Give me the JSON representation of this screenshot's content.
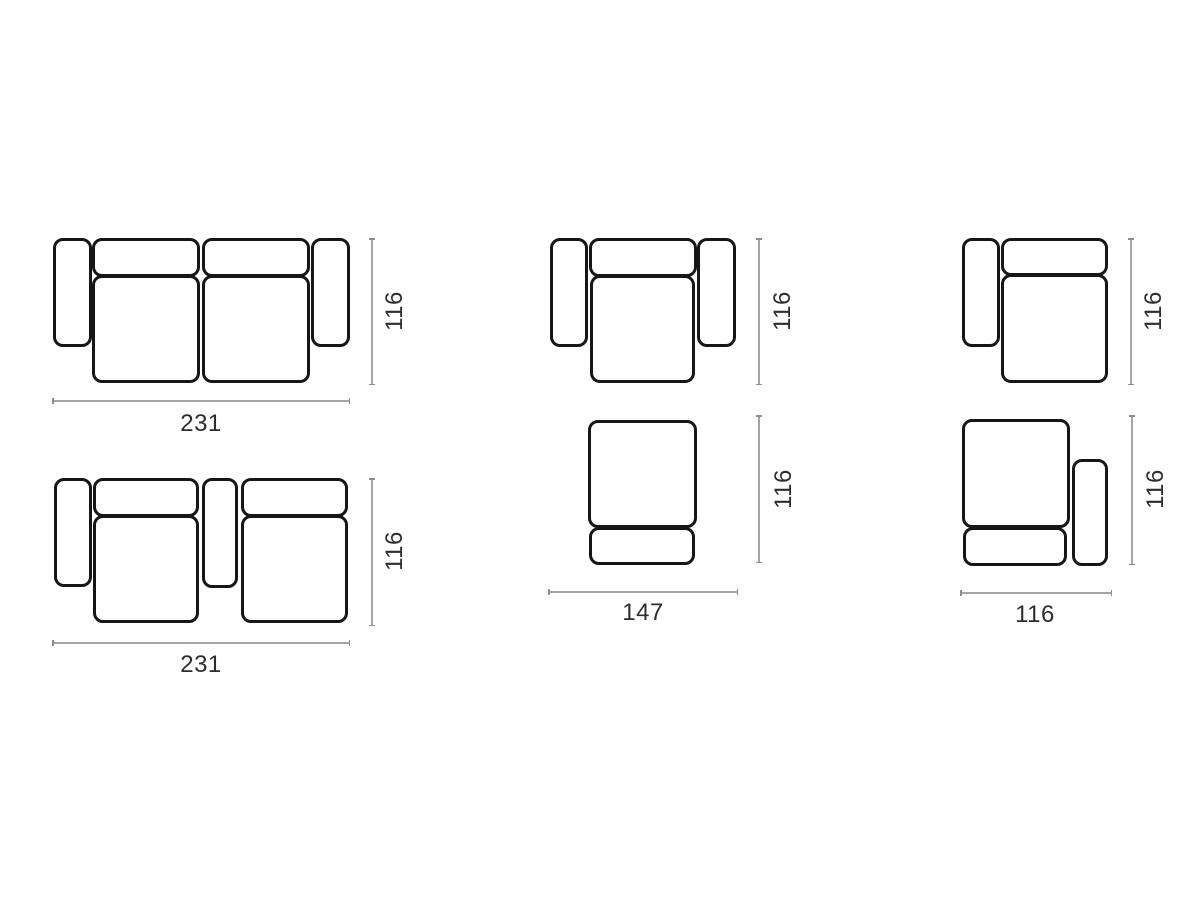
{
  "page": {
    "background_color": "#ffffff",
    "outline_color": "#161616",
    "dimension_line_color": "#a5a5a5",
    "label_color": "#2d2d2d"
  },
  "diagrams": {
    "sofa_two_arms": {
      "width_label": "231",
      "height_label": "116"
    },
    "sofa_middle_arm": {
      "width_label": "231",
      "height_label": "116"
    },
    "armchair": {
      "height_label": "116"
    },
    "seat_back_module": {
      "width_label": "147",
      "height_label": "116"
    },
    "left_arm_module": {
      "height_label": "116"
    },
    "right_arm_module": {
      "width_label": "116",
      "height_label": "116"
    }
  }
}
